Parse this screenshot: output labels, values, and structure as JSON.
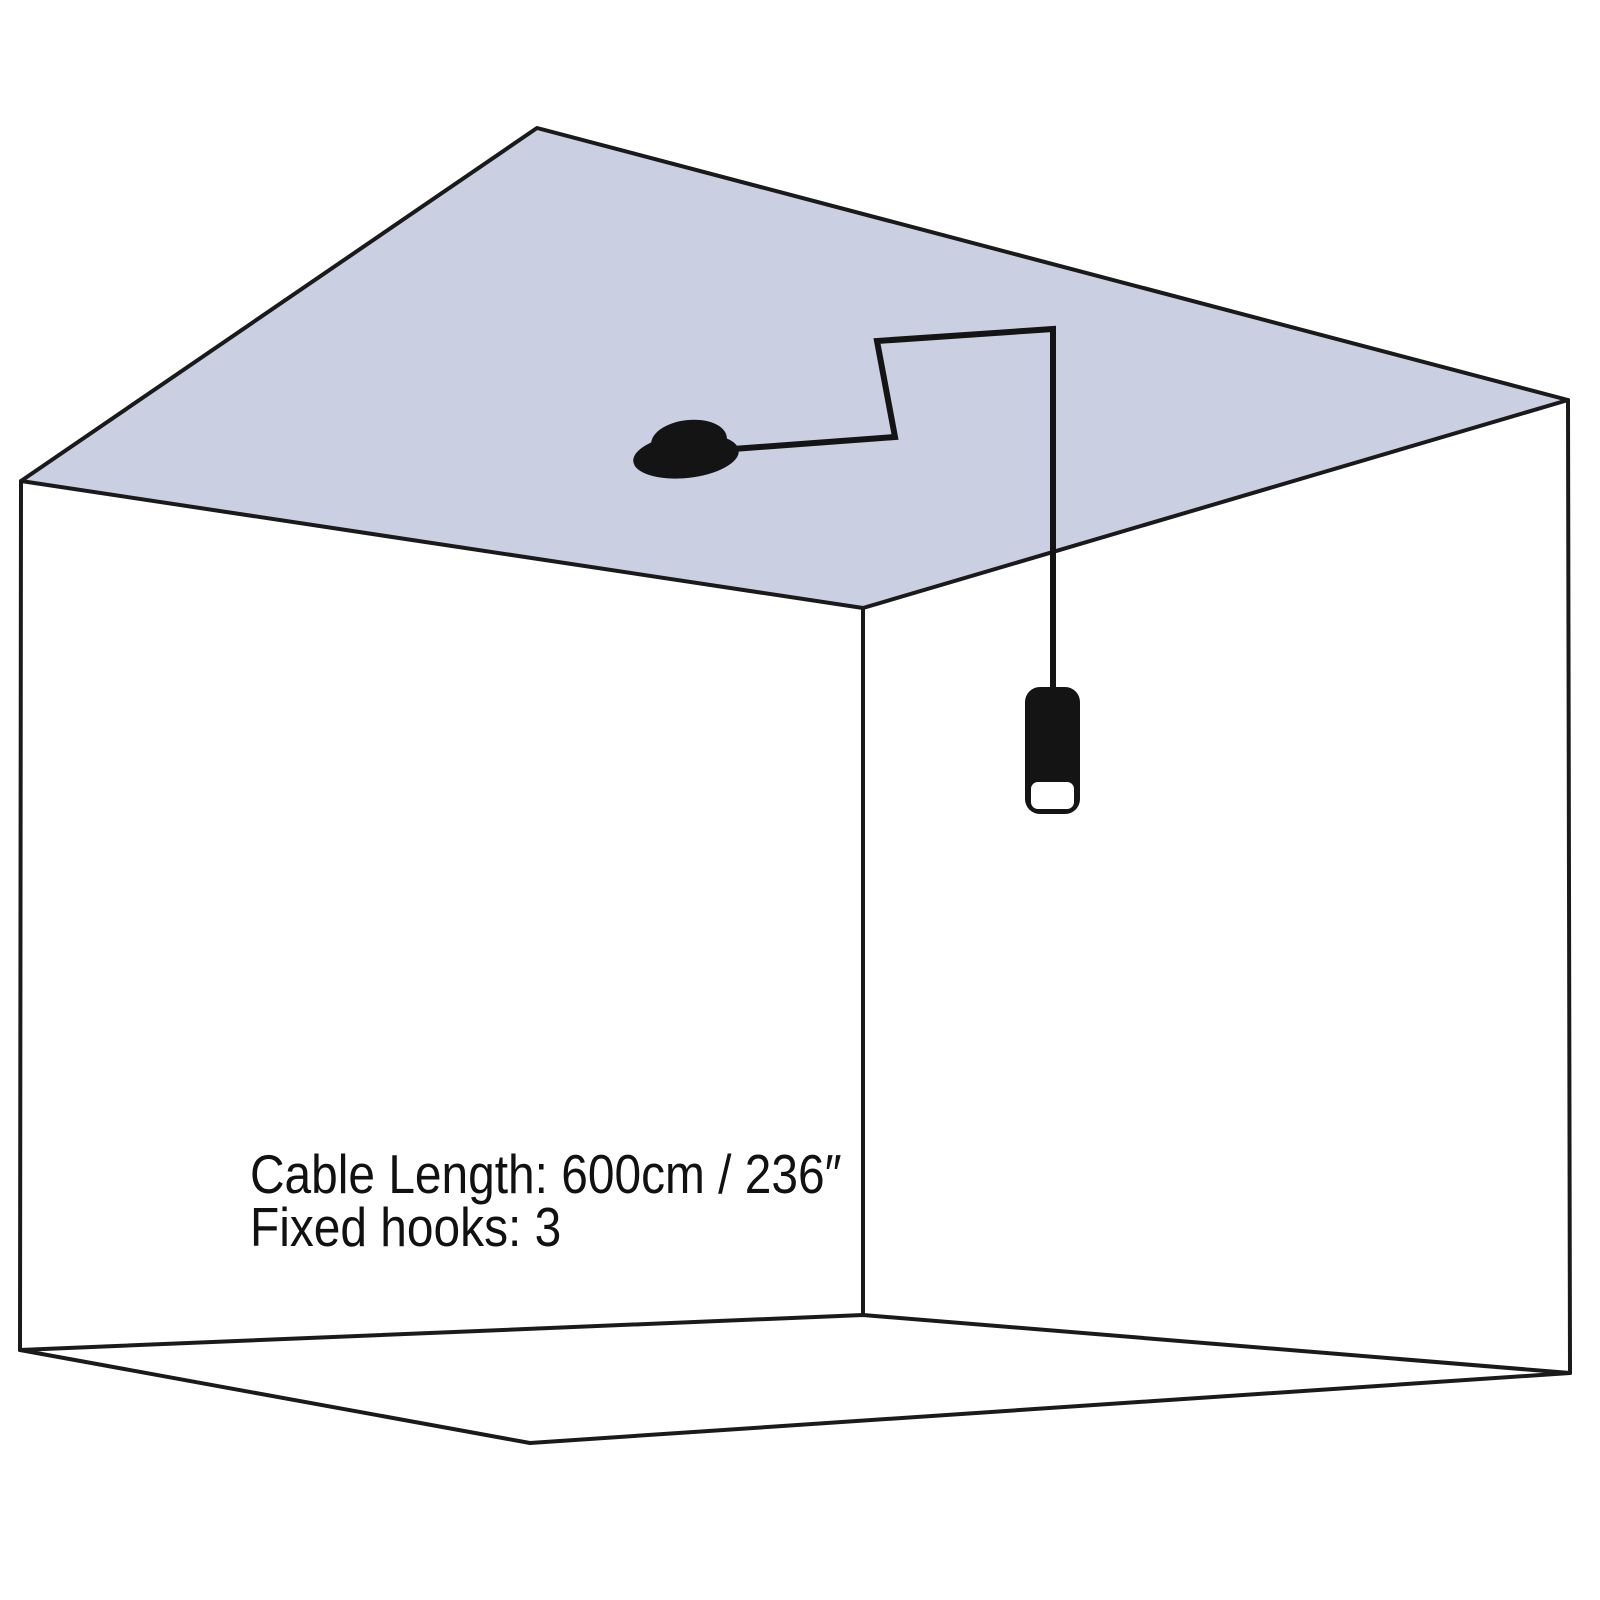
{
  "annotation": {
    "line1": "Cable Length: 600cm / 236″",
    "line2": "Fixed hooks: 3"
  },
  "specs": {
    "cable_length_cm": 600,
    "cable_length_inches": 236,
    "fixed_hooks": 3
  },
  "colors": {
    "background": "#ffffff",
    "ceiling_fill": "#cbcfe2",
    "line": "#1a1a1a",
    "fixture_ink": "#141414",
    "bulb_window": "#ffffff",
    "text": "#111111"
  }
}
